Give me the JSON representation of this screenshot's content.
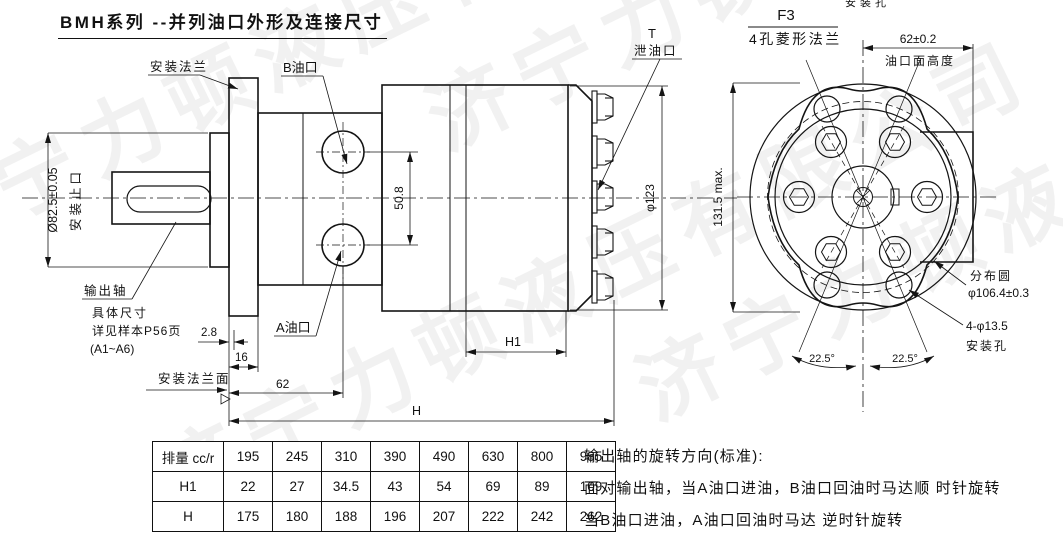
{
  "page": {
    "title": "BMH系列 --并列油口外形及连接尺寸"
  },
  "watermark": {
    "text": "济宁力顿液压有限公司"
  },
  "side_view": {
    "labels": {
      "mount_flange": "安装法兰",
      "b_port": "B油口",
      "a_port": "A油口",
      "t": "T",
      "drain_port": "泄油口",
      "output_shaft": "输出轴",
      "note1": "具体尺寸",
      "note2": "详见样本P56页",
      "note3": "(A1~A6)",
      "mount_face": "安装法兰面",
      "spigot_dim": "Ø82.5±0.05",
      "spigot_name": "安装止口",
      "port_spacing": "50.8",
      "body_dia": "φ123",
      "dim_2_8": "2.8",
      "dim_16": "16",
      "dim_62": "62",
      "dim_h": "H",
      "dim_h1": "H1"
    }
  },
  "front_view": {
    "header": {
      "code": "F3",
      "name": "4孔菱形法兰"
    },
    "labels": {
      "clipped_top": "安装孔",
      "port_face_dim": "62±0.2",
      "port_face_name": "油口面高度",
      "height_max": "131.5 max.",
      "dist_circle_name": "分布圆",
      "dist_circle_dim": "φ106.4±0.3",
      "mount_holes_dim": "4-φ13.5",
      "mount_holes_name": "安装孔",
      "angle_left": "22.5°",
      "angle_right": "22.5°"
    }
  },
  "table": {
    "rows": [
      [
        "排量 cc/r",
        "195",
        "245",
        "310",
        "390",
        "490",
        "630",
        "800",
        "985"
      ],
      [
        "H1",
        "22",
        "27",
        "34.5",
        "43",
        "54",
        "69",
        "89",
        "109"
      ],
      [
        "H",
        "175",
        "180",
        "188",
        "196",
        "207",
        "222",
        "242",
        "262"
      ]
    ]
  },
  "rotation_note": {
    "line1": "输出轴的旋转方向(标准):",
    "line2": "面对输出轴，当A油口进油，B油口回油时马达顺 时针旋转",
    "line3": "当B油口进油，A油口回油时马达 逆时针旋转"
  },
  "colors": {
    "line": "#141414",
    "background": "#ffffff",
    "watermark": "rgba(0,0,0,0.055)"
  }
}
